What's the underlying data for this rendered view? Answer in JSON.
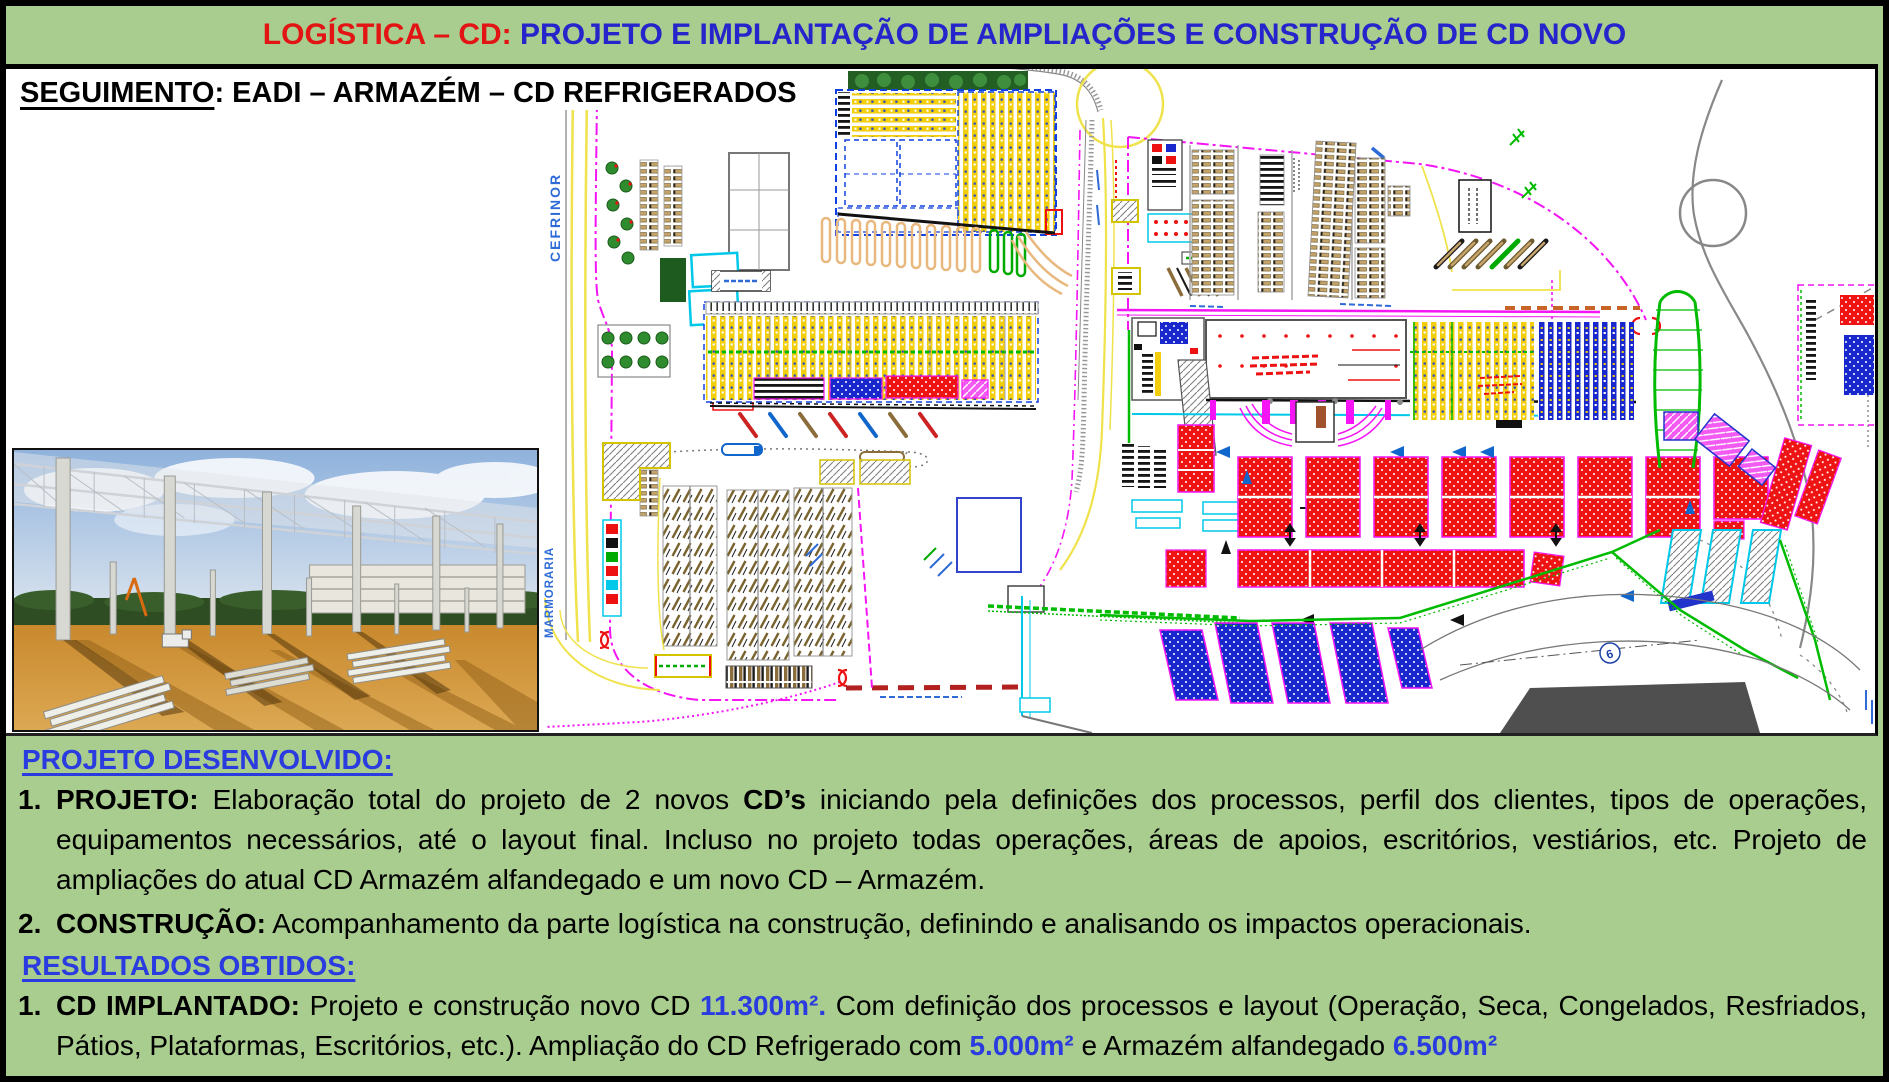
{
  "colors": {
    "slide_green": "#A9CD8E",
    "border_black": "#000000",
    "title_red": "#E21414",
    "title_blue": "#2525CB",
    "heading_blue": "#2A3BDF"
  },
  "header": {
    "title_red": "LOGÍSTICA – CD: ",
    "title_blue": "PROJETO E IMPLANTAÇÃO DE AMPLIAÇÕES E CONSTRUÇÃO DE CD NOVO"
  },
  "subheader": {
    "underlined": "SEGUIMENTO",
    "rest": ": EADI – ARMAZÉM – CD REFRIGERADOS"
  },
  "site_plan": {
    "road_label_vertical_1": "CEFRINOR",
    "road_label_vertical_2": "MARMORARIA",
    "circle_marker": "6"
  },
  "footer": {
    "developed_heading": "PROJETO DESENVOLVIDO:",
    "results_heading": "RESULTADOS OBTIDOS:",
    "developed_items": [
      {
        "num": "1.",
        "label": "PROJETO:",
        "text_a": " Elaboração total do projeto de 2 novos ",
        "bold_a": "CD’s",
        "text_b": " iniciando pela definições dos processos, perfil dos clientes, tipos de operações, equipamentos necessários, até o layout final. Incluso no projeto todas operações, áreas de apoios, escritórios, vestiários, etc. Projeto de ampliações do atual CD Armazém alfandegado e um novo CD – Armazém."
      },
      {
        "num": "2.",
        "label": "CONSTRUÇÃO:",
        "text_a": " Acompanhamento da parte logística na construção, definindo e analisando os impactos operacionais.",
        "bold_a": "",
        "text_b": ""
      }
    ],
    "results_items": [
      {
        "num": "1.",
        "label": "CD IMPLANTADO:",
        "text_a": " Projeto e construção novo CD ",
        "value_a": "11.300m².",
        "text_b": " Com definição dos processos e layout (Operação, Seca, Congelados, Resfriados, Pátios, Plataformas, Escritórios, etc.). Ampliação do CD Refrigerado com ",
        "value_b": "5.000m²",
        "text_c": " e Armazém alfandegado ",
        "value_d": "6.500m²"
      }
    ]
  }
}
